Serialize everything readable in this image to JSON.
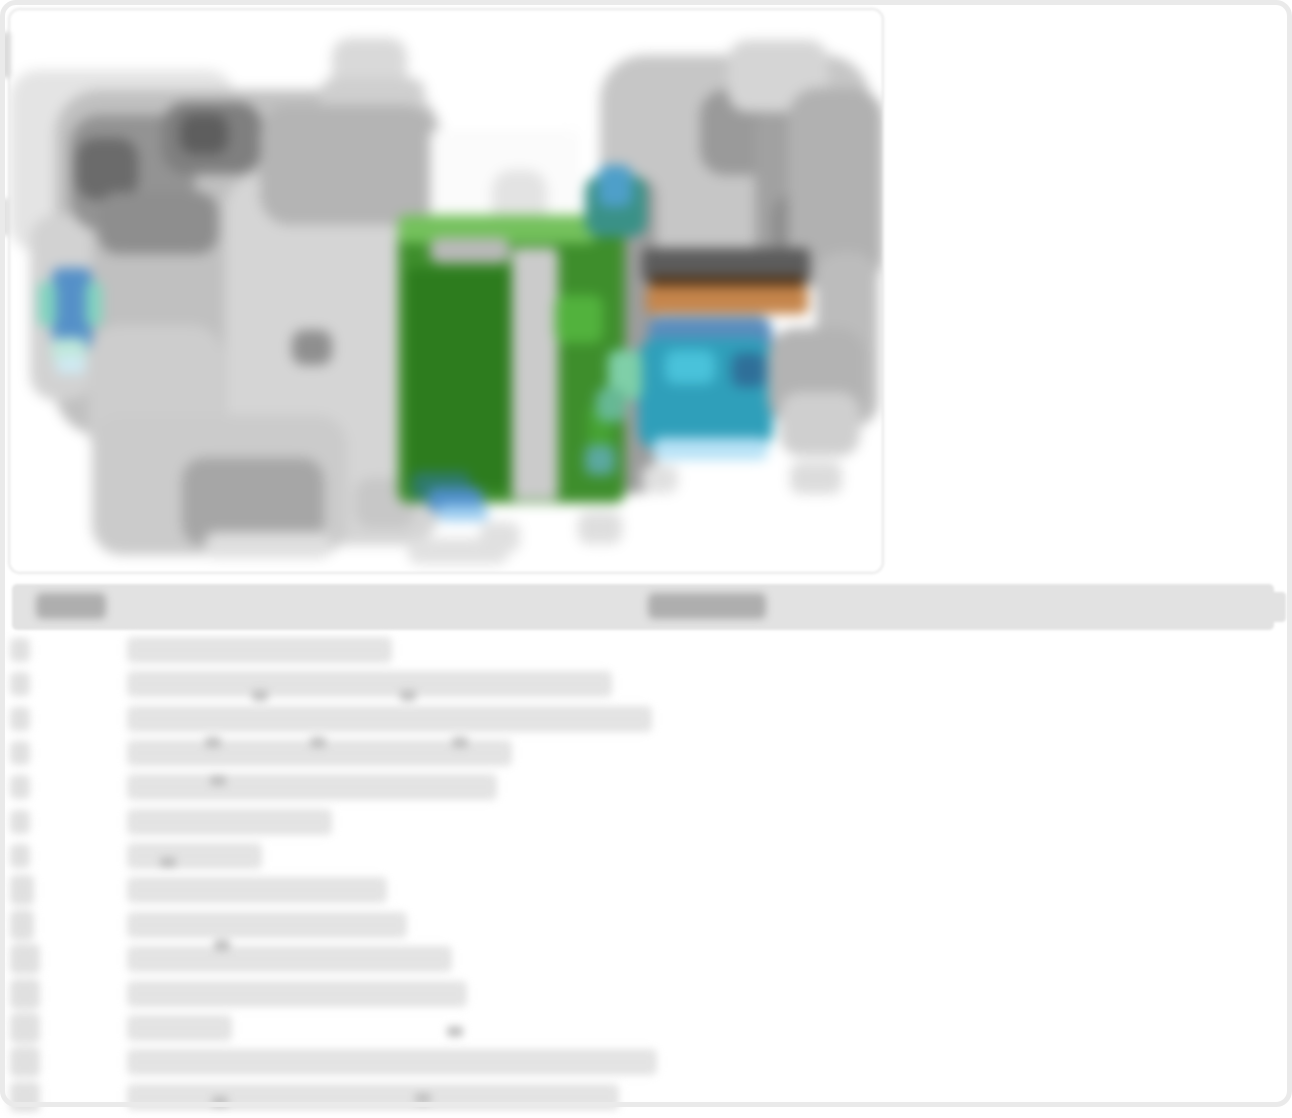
{
  "page": {
    "width": 1292,
    "height": 1107,
    "background": "#ffffff",
    "frame_color": "#eaeaea",
    "note": "All text on this page is blurred/illegible in the source pixels; text is represented as gray redaction bars."
  },
  "photo_card": {
    "x": 8,
    "y": 8,
    "w": 876,
    "h": 566,
    "border_color": "#e7e7e7",
    "radius": 12,
    "content": "engine-bay-photo-blurred",
    "palette": {
      "light_gray": "#e2e2e2",
      "mid_gray": "#c0c0c0",
      "dark_gray": "#6b6b6b",
      "relay_box_green": "#3e8e2c",
      "relay_box_green_dark": "#2d7c1e",
      "relay_box_green_light": "#74c15c",
      "reservoir_teal": "#2f9fba",
      "reservoir_blue": "#5b8dbd",
      "reservoir_cyan": "#49c2da",
      "cowl_orange": "#c5854b",
      "cowl_dark": "#5c5c5c",
      "cowl_brown": "#4d3116",
      "cap_blue": "#5590c8",
      "cap_mint": "#82d4bf"
    },
    "blobs": [
      [
        0,
        60,
        225,
        182,
        "#e4e4e4",
        28
      ],
      [
        45,
        80,
        385,
        345,
        "#c0c0c0",
        45
      ],
      [
        20,
        205,
        62,
        185,
        "#d2d2d2",
        25
      ],
      [
        60,
        105,
        125,
        115,
        "#939393",
        30
      ],
      [
        66,
        128,
        62,
        62,
        "#6b6b6b",
        20
      ],
      [
        152,
        92,
        100,
        72,
        "#7f7f7f",
        25
      ],
      [
        170,
        104,
        48,
        40,
        "#5e5e5e",
        14
      ],
      [
        88,
        182,
        120,
        62,
        "#8e8e8e",
        20
      ],
      [
        215,
        165,
        215,
        370,
        "#d5d5d5",
        35
      ],
      [
        322,
        28,
        75,
        55,
        "#d9d9d9",
        18
      ],
      [
        310,
        68,
        105,
        40,
        "#cfcfcf",
        14
      ],
      [
        250,
        95,
        175,
        120,
        "#b4b4b4",
        30
      ],
      [
        282,
        320,
        40,
        35,
        "#8f8f8f",
        12
      ],
      [
        345,
        468,
        60,
        50,
        "#c7c7c7",
        16
      ],
      [
        420,
        120,
        150,
        112,
        "#fbfbfb",
        6
      ],
      [
        482,
        160,
        55,
        70,
        "#e3e3e3",
        20
      ],
      [
        590,
        45,
        270,
        220,
        "#c6c6c6",
        45
      ],
      [
        690,
        80,
        90,
        85,
        "#9a9a9a",
        25
      ],
      [
        745,
        92,
        118,
        170,
        "#a1a1a1",
        30
      ],
      [
        762,
        185,
        65,
        65,
        "#8d8d8d",
        20
      ],
      [
        718,
        30,
        100,
        72,
        "#d5d5d5",
        20
      ],
      [
        778,
        78,
        95,
        200,
        "#b1b1b1",
        30
      ],
      [
        806,
        242,
        62,
        175,
        "#bcbcbc",
        25
      ],
      [
        598,
        168,
        48,
        315,
        "#9d9d9d",
        16
      ],
      [
        388,
        205,
        227,
        288,
        "#3e8e2c",
        10
      ],
      [
        396,
        258,
        128,
        222,
        "#2d7c1e",
        8
      ],
      [
        388,
        205,
        198,
        28,
        "#74c15c",
        8
      ],
      [
        420,
        228,
        80,
        25,
        "#b9b9b9",
        10
      ],
      [
        502,
        238,
        46,
        252,
        "#cbcbcb",
        6
      ],
      [
        545,
        285,
        48,
        48,
        "#52b23d",
        10
      ],
      [
        578,
        395,
        24,
        70,
        "#46a332",
        8
      ],
      [
        575,
        435,
        30,
        30,
        "#5ba8a0",
        8
      ],
      [
        575,
        165,
        62,
        62,
        "#3a9187",
        16
      ],
      [
        588,
        155,
        34,
        42,
        "#4e9fc9",
        10
      ],
      [
        402,
        462,
        58,
        28,
        "#2e7a6a",
        8
      ],
      [
        418,
        478,
        55,
        24,
        "#4f8fc9",
        8
      ],
      [
        428,
        495,
        50,
        16,
        "#9ccdf0",
        6
      ],
      [
        632,
        238,
        168,
        34,
        "#5c5c5c",
        6
      ],
      [
        640,
        266,
        155,
        12,
        "#4d3116",
        4
      ],
      [
        636,
        276,
        162,
        28,
        "#c5854b",
        6
      ],
      [
        638,
        306,
        124,
        54,
        "#5b8dbd",
        14
      ],
      [
        628,
        328,
        135,
        112,
        "#2f9fba",
        20
      ],
      [
        655,
        340,
        50,
        34,
        "#49c2da",
        10
      ],
      [
        722,
        343,
        34,
        34,
        "#2f6f99",
        8
      ],
      [
        643,
        428,
        115,
        22,
        "#b7e2f6",
        8
      ],
      [
        598,
        340,
        34,
        50,
        "#7fcfa8",
        10
      ],
      [
        586,
        378,
        30,
        34,
        "#66b894",
        10
      ],
      [
        758,
        318,
        98,
        98,
        "#b3b3b3",
        28
      ],
      [
        770,
        382,
        80,
        64,
        "#cfcfcf",
        20
      ],
      [
        42,
        258,
        40,
        82,
        "#5590c8",
        8
      ],
      [
        28,
        272,
        18,
        44,
        "#82d4bf",
        6
      ],
      [
        76,
        272,
        16,
        44,
        "#82d4bf",
        6
      ],
      [
        42,
        328,
        34,
        24,
        "#bfe8da",
        6
      ],
      [
        46,
        346,
        30,
        18,
        "#cfe9f2",
        6
      ],
      [
        78,
        315,
        135,
        135,
        "#cdcdcd",
        32
      ],
      [
        82,
        405,
        255,
        140,
        "#cbcbcb",
        30
      ],
      [
        172,
        448,
        142,
        88,
        "#a6a6a6",
        22
      ],
      [
        195,
        522,
        125,
        26,
        "#dfdfdf",
        10
      ],
      [
        398,
        528,
        100,
        26,
        "#e1e1e1",
        10
      ],
      [
        470,
        512,
        40,
        30,
        "#e0e0e0",
        10
      ],
      [
        568,
        502,
        44,
        32,
        "#dedede",
        10
      ],
      [
        632,
        455,
        36,
        28,
        "#e0e0e0",
        10
      ],
      [
        780,
        452,
        52,
        32,
        "#dcdcdc",
        10
      ]
    ]
  },
  "table": {
    "header": {
      "x": 12,
      "y": 584,
      "w": 1262,
      "h": 46,
      "background": "#e2e2e2",
      "pill_color": "#aeaeae",
      "nub": {
        "x": 1270,
        "y": 592,
        "w": 16,
        "h": 30
      },
      "columns": [
        {
          "name": "column-header-left",
          "label_illegible": true,
          "pill": {
            "x": 36,
            "y": 593,
            "w": 70,
            "h": 26
          }
        },
        {
          "name": "column-header-right",
          "label_illegible": true,
          "pill": {
            "x": 648,
            "y": 593,
            "w": 118,
            "h": 26
          }
        }
      ]
    },
    "rows_top": 637,
    "row_pitch": 34.35,
    "num_x": 10,
    "desc_x": 127,
    "desc_h": 26,
    "bar_color": "#e3e3e3",
    "num_color": "#e0e0e0",
    "speck_color": "#c2c2c2",
    "rows": [
      {
        "num_w": 20,
        "num_h": 24,
        "desc_w": 265
      },
      {
        "num_w": 20,
        "num_h": 24,
        "desc_w": 485
      },
      {
        "num_w": 20,
        "num_h": 24,
        "desc_w": 525
      },
      {
        "num_w": 20,
        "num_h": 24,
        "desc_w": 385
      },
      {
        "num_w": 20,
        "num_h": 24,
        "desc_w": 370
      },
      {
        "num_w": 20,
        "num_h": 24,
        "desc_w": 205
      },
      {
        "num_w": 20,
        "num_h": 24,
        "desc_w": 135
      },
      {
        "num_w": 24,
        "num_h": 30,
        "desc_w": 260
      },
      {
        "num_w": 24,
        "num_h": 30,
        "desc_w": 280
      },
      {
        "num_w": 30,
        "num_h": 30,
        "desc_w": 325
      },
      {
        "num_w": 30,
        "num_h": 30,
        "desc_w": 340
      },
      {
        "num_w": 30,
        "num_h": 30,
        "desc_w": 105
      },
      {
        "num_w": 30,
        "num_h": 30,
        "desc_w": 530
      },
      {
        "num_w": 30,
        "num_h": 30,
        "desc_w": 492
      }
    ],
    "specks": [
      [
        252,
        690
      ],
      [
        400,
        690
      ],
      [
        205,
        737
      ],
      [
        310,
        737
      ],
      [
        452,
        737
      ],
      [
        210,
        775
      ],
      [
        160,
        857
      ],
      [
        214,
        940
      ],
      [
        447,
        1026
      ],
      [
        212,
        1096
      ],
      [
        415,
        1093
      ]
    ]
  },
  "edge_artifacts": [
    {
      "x": 0,
      "y": 32,
      "w": 11,
      "h": 46,
      "color": "#dcdcdc"
    },
    {
      "x": 0,
      "y": 198,
      "w": 9,
      "h": 38,
      "color": "#e0e0e0"
    }
  ]
}
